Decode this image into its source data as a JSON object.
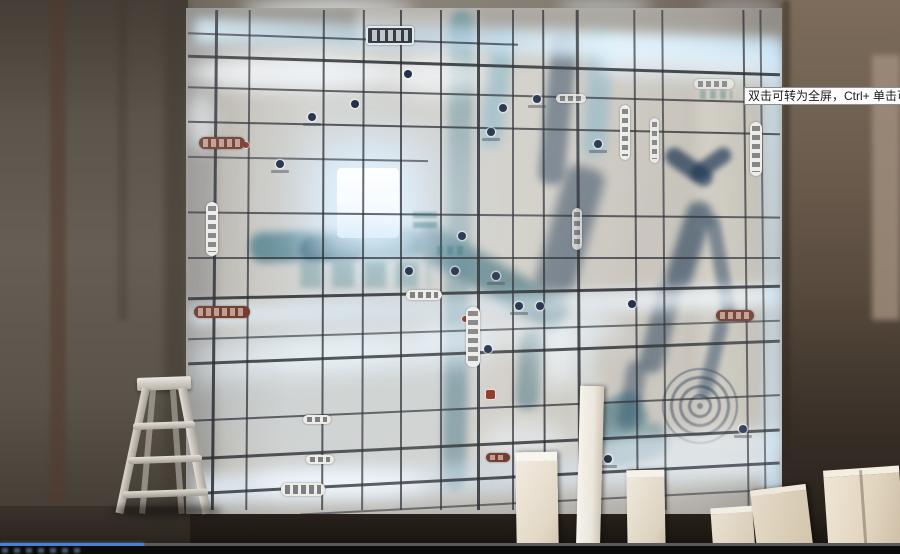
{
  "video_player": {
    "tooltip_text": "双击可转为全屏，Ctrl+ 单击可转为",
    "progress_percent": 16,
    "colors": {
      "progress_played": "#4d80cc",
      "progress_track": "#5a5a5a",
      "control_bar": "#0b0b0b"
    }
  },
  "scene": {
    "colors": {
      "map_panel": "#d2cfc8",
      "led_glow": "#e8f4ff",
      "river_teal": "#2f6b7a",
      "river_navy": "#1e3a5c",
      "road_line": "#272a30",
      "wall_left": "#5c554c",
      "wall_right": "#6b5c4e",
      "ladder": "#d0ccc4",
      "foreground_boards": "#efe7d8"
    }
  }
}
